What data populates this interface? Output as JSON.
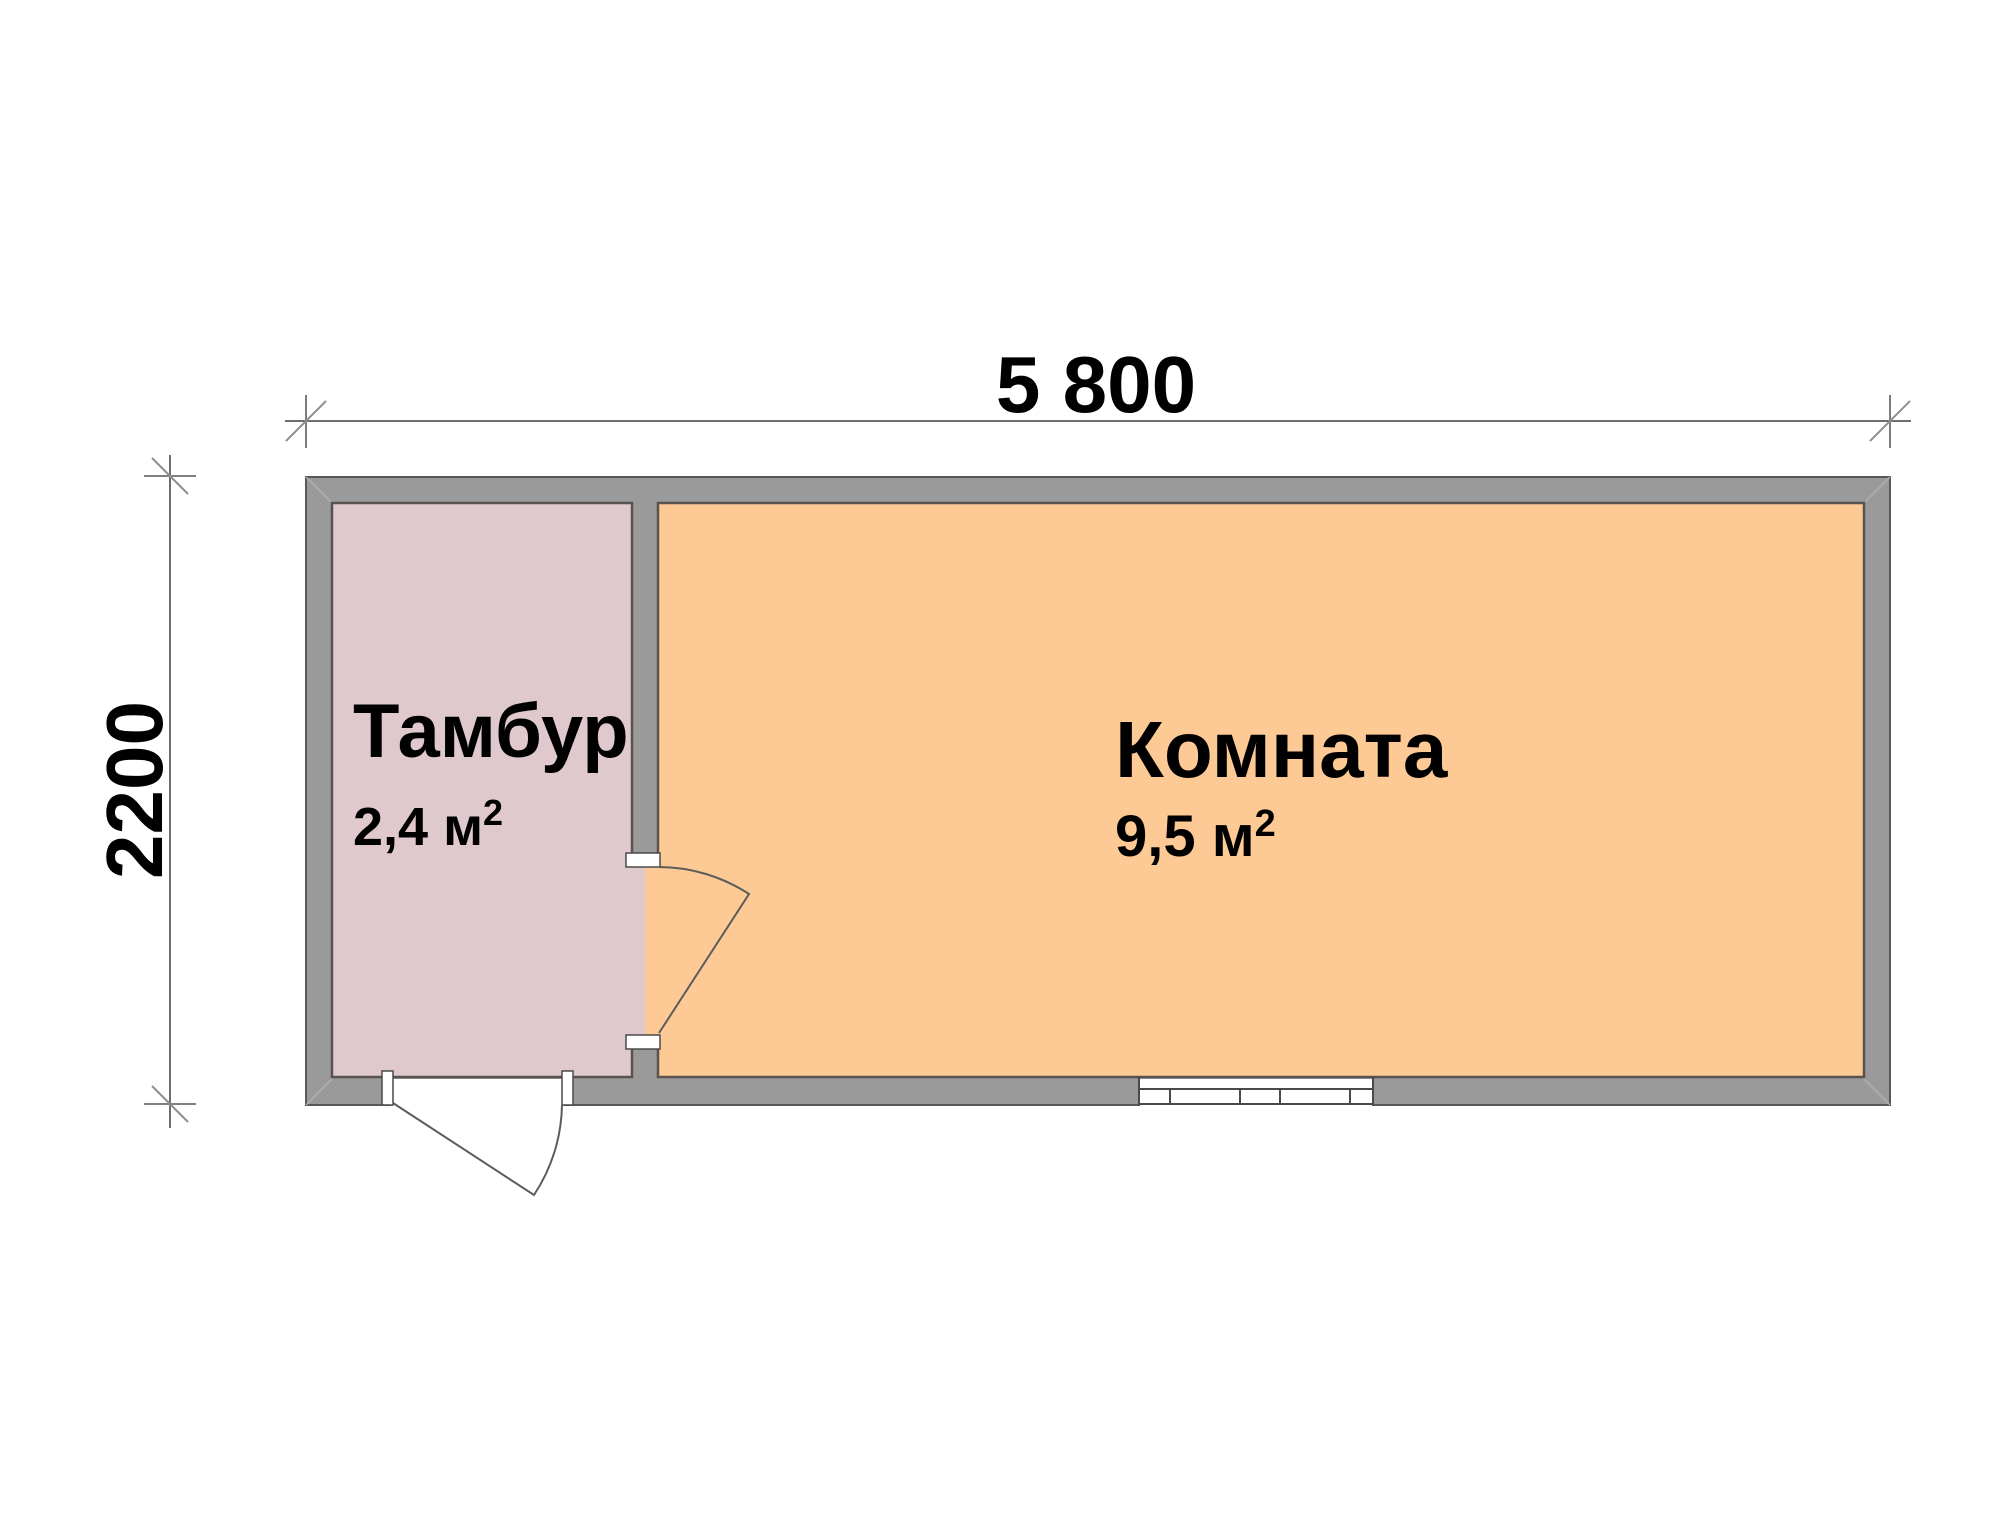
{
  "plan": {
    "dimension_width": {
      "label": "5 800"
    },
    "dimension_height": {
      "label": "2200"
    },
    "rooms": [
      {
        "name": "Тамбур",
        "area": "2,4 м",
        "area_superscript": "2",
        "fill": "#dfc9cd"
      },
      {
        "name": "Комната",
        "area": "9,5 м",
        "area_superscript": "2",
        "fill": "#fdca95"
      }
    ],
    "colors": {
      "wall_fill": "#9a9a9a",
      "wall_outline": "#58585a",
      "room_border": "#59534f",
      "dimension_line": "#6e6e6e",
      "tick_slash": "#8f8f8f",
      "door_line": "#5c5c5c",
      "frame_line": "#4a4a4a",
      "bevel_line": "#b0afaf",
      "jamb_fill": "#ffffff",
      "background": "#ffffff"
    }
  }
}
